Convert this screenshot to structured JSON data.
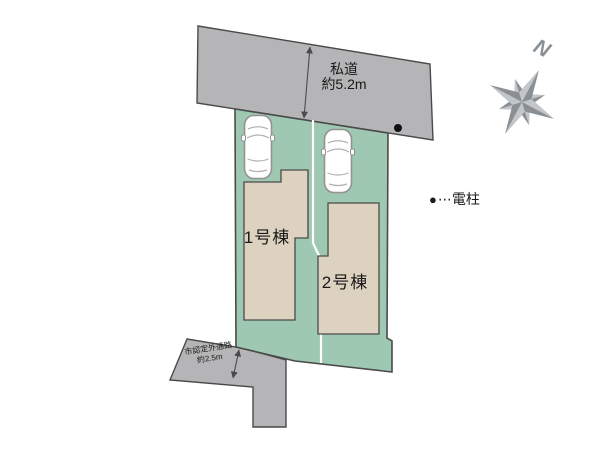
{
  "plan": {
    "private_road": {
      "line1": "私道",
      "line2": "約5.2m"
    },
    "side_road": {
      "line1": "市認定外通路",
      "line2": "約2.5m"
    },
    "buildings": [
      {
        "label": "1号棟"
      },
      {
        "label": "2号棟"
      }
    ],
    "legend": {
      "dot": "●",
      "text": "⋯電柱"
    },
    "compass": {
      "north": "N"
    }
  },
  "colors": {
    "road": "#b5b5b7",
    "lot": "#9fc8b3",
    "building": "#ddd1bf",
    "outline": "#4a4a4a",
    "divider": "#ffffff",
    "compass": "#8a8f94",
    "compass-light": "#c2c6c9",
    "text": "#1a1a1a",
    "car-stroke": "#939393",
    "dot": "#111111"
  }
}
